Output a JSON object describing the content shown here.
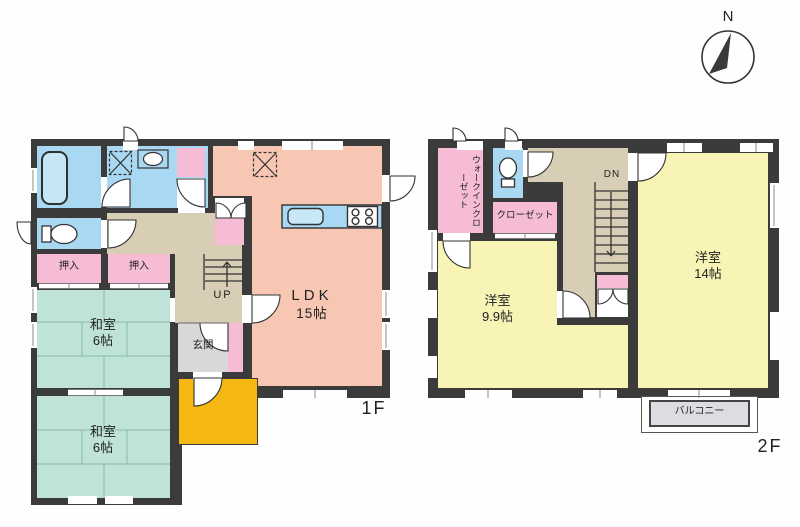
{
  "compass": {
    "north_label": "N"
  },
  "floor1": {
    "label": "1F",
    "ldk": {
      "name": "LDK",
      "size": "15帖"
    },
    "washitsu_1": {
      "name": "和室",
      "size": "6帖"
    },
    "washitsu_2": {
      "name": "和室",
      "size": "6帖"
    },
    "oshiire_1": "押入",
    "oshiire_2": "押入",
    "genkan": "玄関",
    "stairs": "UP"
  },
  "floor2": {
    "label": "2F",
    "yoshitsu_small": {
      "name": "洋室",
      "size": "9.9帖"
    },
    "yoshitsu_large": {
      "name": "洋室",
      "size": "14帖"
    },
    "walk_in_closet": "ウォークインクローゼット",
    "closet": "クローゼット",
    "balcony": "バルコニー",
    "stairs": "DN"
  },
  "colors": {
    "wall": "#3b3b3b",
    "ldk": "#f7c7b4",
    "western_room": "#f8f4b6",
    "tatami": "#c0e3d8",
    "water_area": "#a9d8f2",
    "closet_pink": "#f6bcd5",
    "corridor": "#d8cdb5",
    "genkan": "#d8d8d8",
    "porch": "#f5b812",
    "balcony": "#dcdce2"
  }
}
